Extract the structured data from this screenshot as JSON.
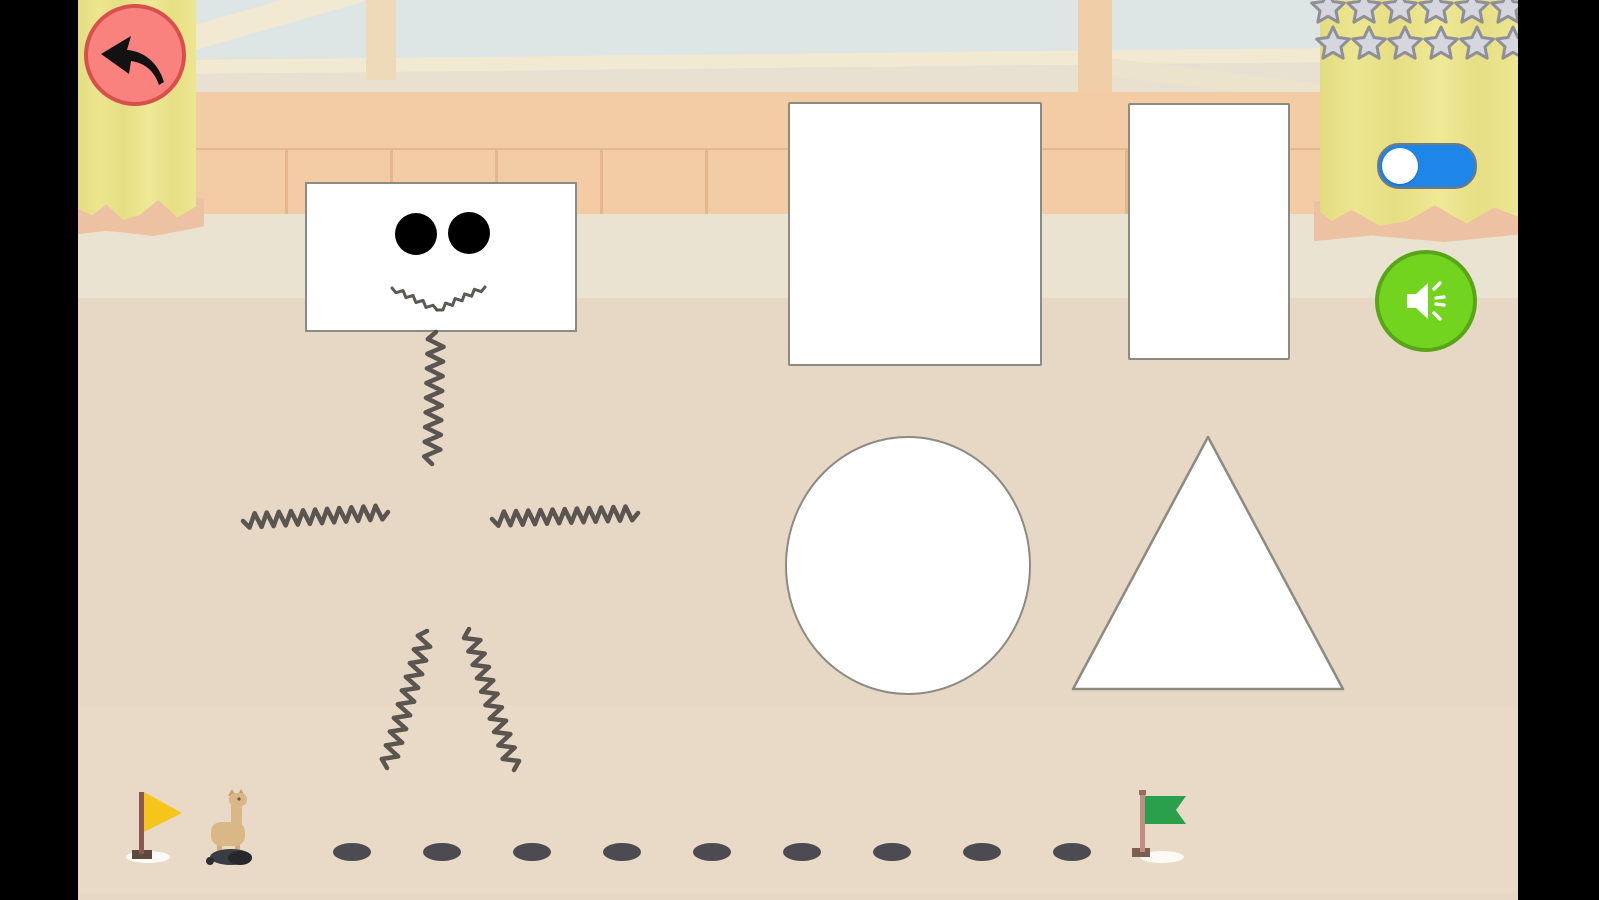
{
  "hud": {
    "back_button": {
      "icon": "back-arrow-icon",
      "fill": "#f9827f",
      "border": "#d7504c"
    },
    "stars": {
      "rows": 2,
      "per_row": 6,
      "total": 12,
      "state": "empty",
      "fill": "#d6d6de",
      "outline": "#8f8f99"
    },
    "music_toggle": {
      "knob_position": "left",
      "track_color": "#1f86e9",
      "knob_color": "#ffffff"
    },
    "sound_button": {
      "icon": "speaker-icon",
      "fill": "#72d41f",
      "border": "#58a617"
    }
  },
  "drawing": {
    "figure": {
      "head": {
        "shape": "rectangle",
        "eyes": 2,
        "mouth": "zigzag-smile"
      },
      "strokes": [
        "neck",
        "left-arm",
        "right-arm",
        "left-leg",
        "right-leg"
      ],
      "stroke_color": "#4e4a45"
    },
    "shape_cards": [
      {
        "type": "square"
      },
      {
        "type": "rectangle"
      },
      {
        "type": "circle"
      },
      {
        "type": "triangle"
      }
    ],
    "card_fill": "#ffffff",
    "card_outline": "#8b8b82"
  },
  "progress_track": {
    "start_flag": {
      "kind": "pennant",
      "color": "#f6c51b"
    },
    "end_flag": {
      "kind": "swallowtail",
      "color": "#2aa04b"
    },
    "character": "llama",
    "dots": {
      "count": 9,
      "color": "#4b4b51"
    }
  },
  "scene": {
    "curtain_color": "#e9e28b",
    "wall_color": "#f3cba4",
    "floor_color": "#e7d7c5",
    "window_color": "#dee6e5",
    "letterbox_color": "#000000"
  }
}
